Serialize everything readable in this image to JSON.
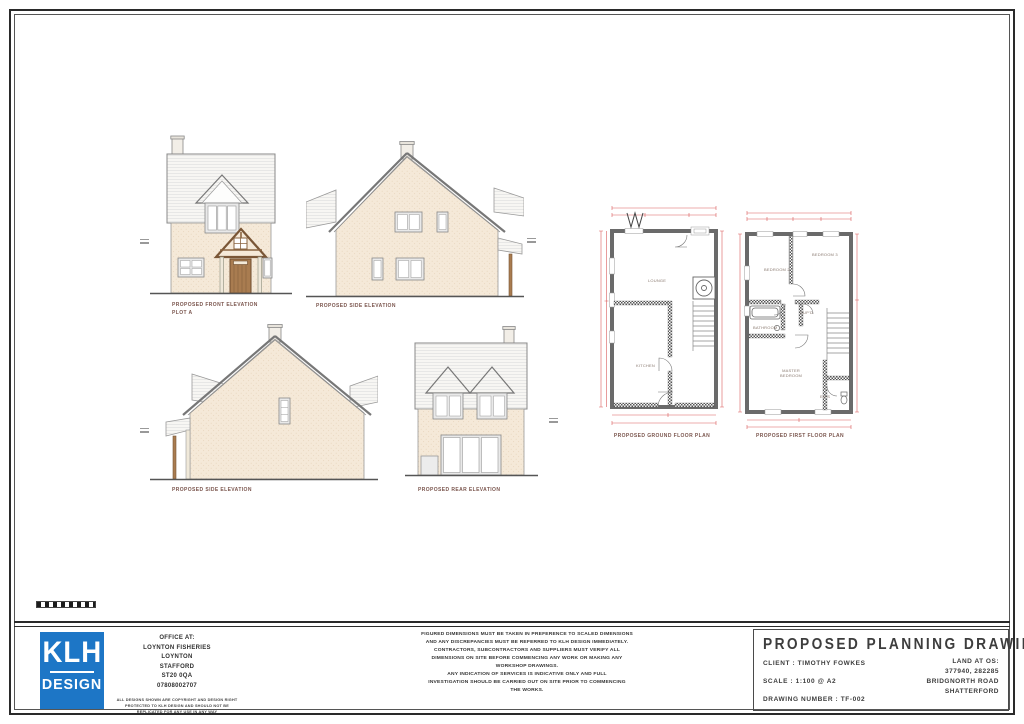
{
  "sheet": {
    "drawings": {
      "front_elevation_label": "PROPOSED FRONT ELEVATION",
      "front_elevation_sublabel": "PLOT A",
      "side_elevation_label": "PROPOSED SIDE ELEVATION",
      "side_elevation2_label": "PROPOSED SIDE ELEVATION",
      "rear_elevation_label": "PROPOSED REAR ELEVATION",
      "ground_floor_label": "PROPOSED GROUND FLOOR PLAN",
      "first_floor_label": "PROPOSED FIRST FLOOR PLAN"
    },
    "rooms": {
      "lounge": "LOUNGE",
      "kitchen": "KITCHEN",
      "bedroom2": "BEDROOM 2",
      "bedroom3": "BEDROOM 3",
      "bathroom": "BATHROOM",
      "cupboard": "CUP'D",
      "master_bedroom_line1": "MASTER",
      "master_bedroom_line2": "BEDROOM",
      "ensuite": "EN S"
    },
    "title_block": {
      "logo_top": "KLH",
      "logo_bottom": "DESIGN",
      "office_lines": [
        "OFFICE AT:",
        "LOYNTON FISHERIES",
        "LOYNTON",
        "STAFFORD",
        "ST20 0QA",
        "07808002707"
      ],
      "copyright_lines": [
        "ALL DESIGNS SHOWN ARE COPYRIGHT AND DESIGN RIGHT",
        "PROTECTED TO KLH DESIGN AND SHOULD NOT BE",
        "REPLICATED FOR ANY USE IN ANY WAY"
      ],
      "disclaimer_lines": [
        "FIGURED DIMENSIONS MUST BE TAKEN IN PREFERENCE TO SCALED DIMENSIONS",
        "AND ANY DISCREPANCIES MUST BE REFERRED TO KLH DESIGN IMMEDIATELY.",
        "CONTRACTORS, SUBCONTRACTORS AND SUPPLIERS MUST VERIFY ALL",
        "DIMENSIONS ON SITE BEFORE COMMENCING ANY WORK OR MAKING ANY",
        "WORKSHOP DRAWINGS.",
        "ANY INDICATION OF SERVICES IS INDICATIVE ONLY AND FULL",
        "INVESTIGATION SHOULD BE CARRIED OUT ON SITE PRIOR TO COMMENCING",
        "THE WORKS."
      ],
      "title": "PROPOSED PLANNING DRAWINGS",
      "client": "CLIENT : TIMOTHY FOWKES",
      "scale": "SCALE : 1:100 @ A2",
      "drawing_number": "DRAWING NUMBER : TF-002",
      "location_lines": [
        "LAND AT OS:",
        "377940, 282285",
        "BRIDGNORTH ROAD",
        "SHATTERFORD"
      ]
    },
    "colors": {
      "logo_blue": "#1d76c6",
      "dimension_red": "#d95b5b",
      "wall_cream": "#f5e9d8",
      "roof_gray": "#f7f6f3",
      "timber_brown": "#a97c50",
      "plan_wall_gray": "#6a6a6a",
      "label_maroon": "#7b564e"
    }
  }
}
